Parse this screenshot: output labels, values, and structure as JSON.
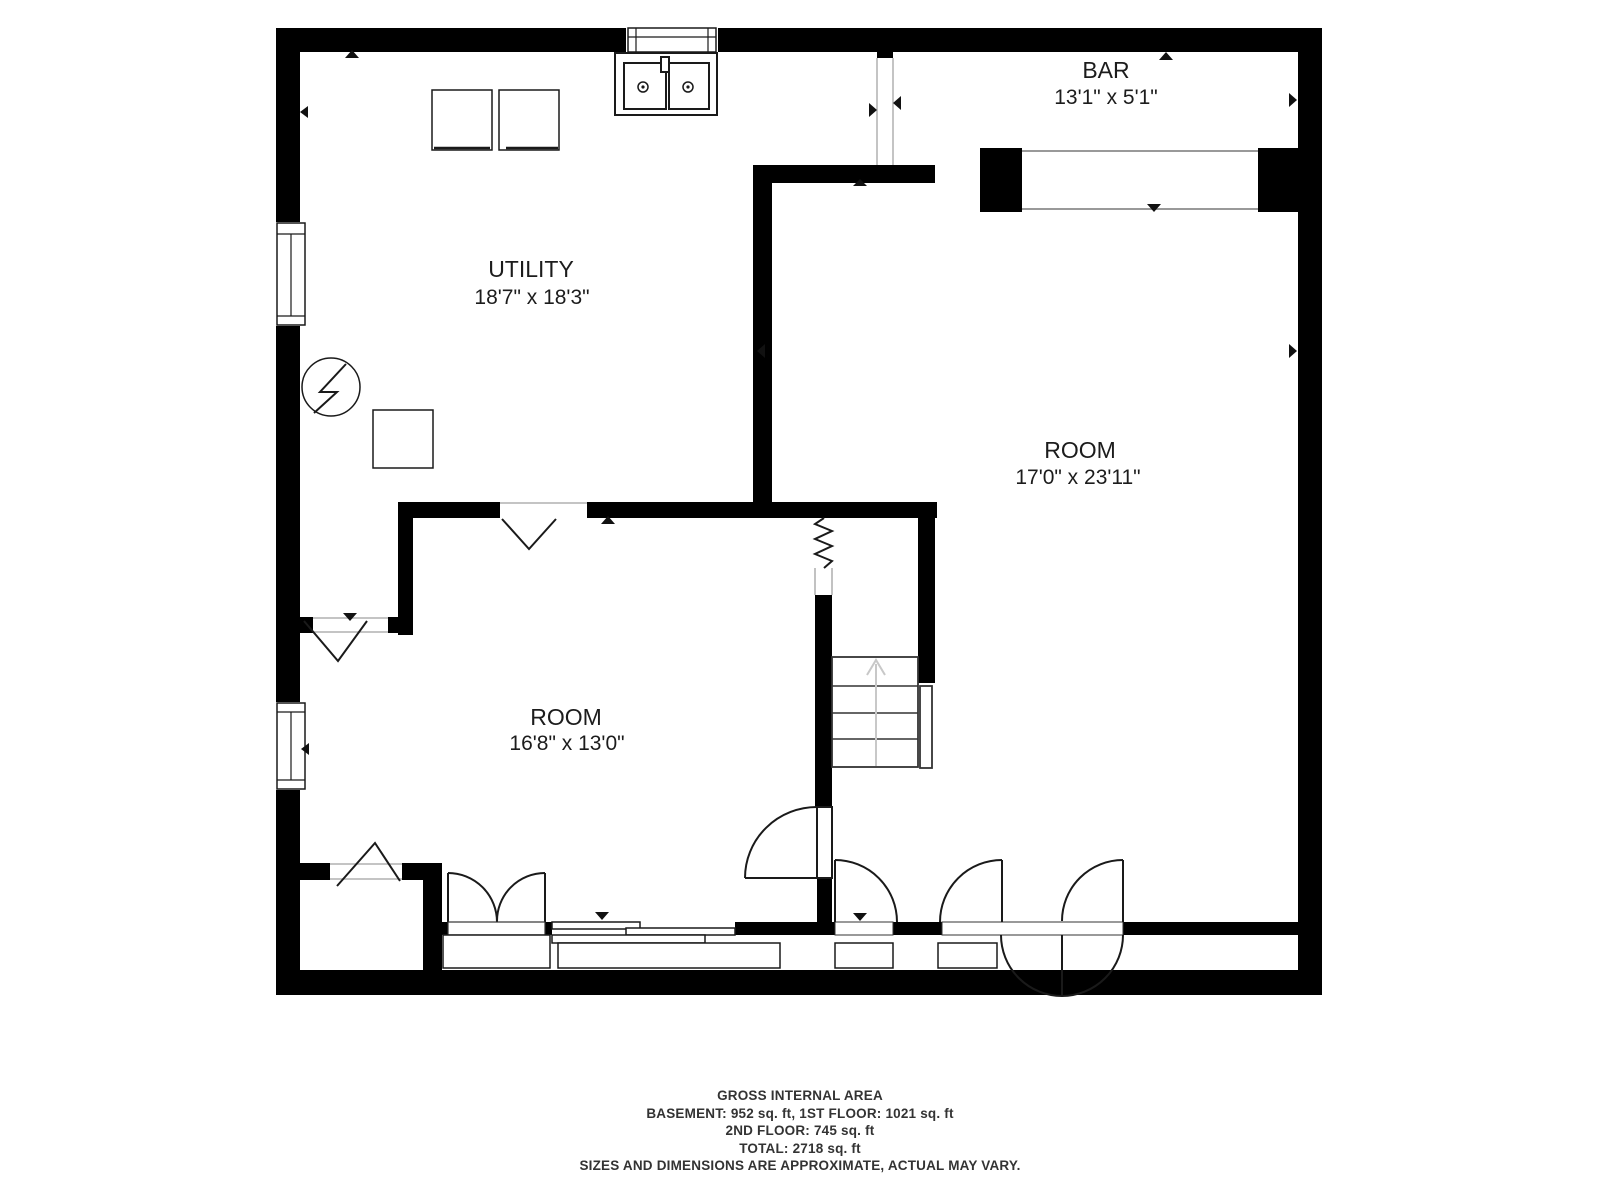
{
  "colors": {
    "walls": "#000000",
    "text": "#1c1c1c",
    "opening_lines": "#b0b0b0",
    "counter_lines": "#999999",
    "stairs_arrow": "#c8c8c8"
  },
  "rooms": [
    {
      "name": "BAR",
      "dimensions": "13'1\" x 5'1\""
    },
    {
      "name": "UTILITY",
      "dimensions": "18'7\" x 18'3\""
    },
    {
      "name": "ROOM",
      "dimensions": "17'0\" x 23'11\""
    },
    {
      "name": "ROOM",
      "dimensions": "16'8\" x 13'0\""
    }
  ],
  "footer": {
    "title": "GROSS INTERNAL AREA",
    "line1": "BASEMENT: 952 sq. ft, 1ST FLOOR: 1021 sq. ft",
    "line2": "2ND FLOOR: 745 sq. ft",
    "line3": "TOTAL: 2718 sq. ft",
    "disclaimer": "SIZES AND DIMENSIONS ARE APPROXIMATE, ACTUAL MAY VARY."
  }
}
